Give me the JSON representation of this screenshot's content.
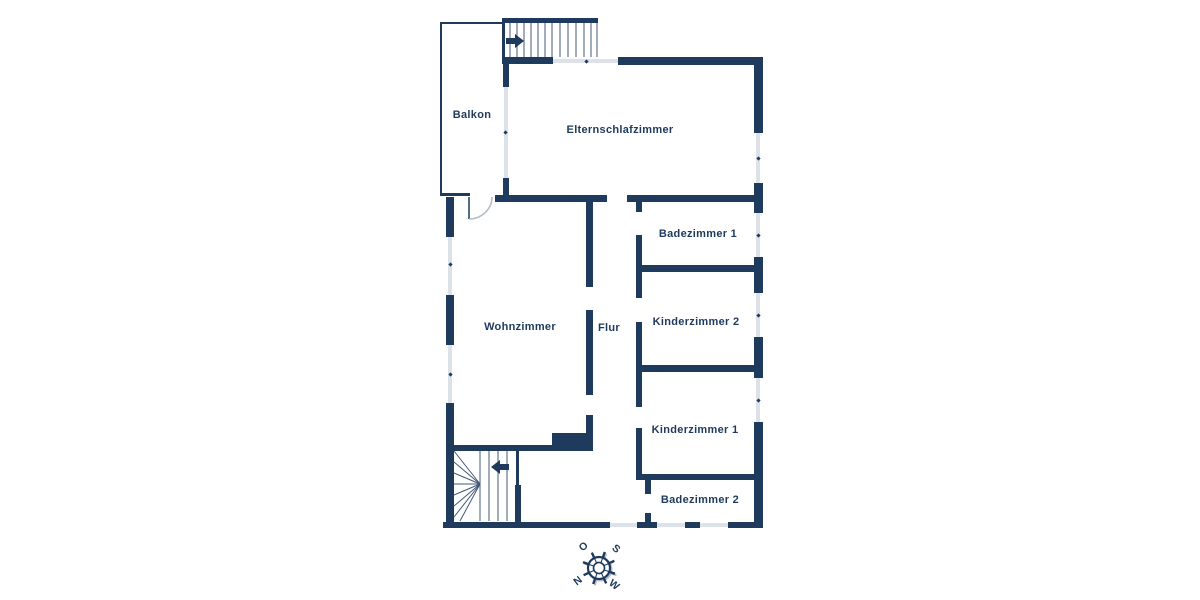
{
  "theme": {
    "wall_color": "#1e3a5c",
    "window_color": "#dde2e9",
    "stair_tread_color": "#53688a",
    "background_color": "#ffffff",
    "label_color": "#1e3a5c"
  },
  "floorplan": {
    "rooms": {
      "balkon": {
        "label": "Balkon"
      },
      "elternschlafzimmer": {
        "label": "Elternschlafzimmer"
      },
      "badezimmer1": {
        "label": "Badezimmer 1"
      },
      "kinderzimmer2": {
        "label": "Kinderzimmer 2"
      },
      "wohnzimmer": {
        "label": "Wohnzimmer"
      },
      "flur": {
        "label": "Flur"
      },
      "kinderzimmer1": {
        "label": "Kinderzimmer 1"
      },
      "badezimmer2": {
        "label": "Badezimmer 2"
      }
    },
    "compass": {
      "east": "O",
      "south": "S",
      "north": "N",
      "west": "W"
    }
  }
}
